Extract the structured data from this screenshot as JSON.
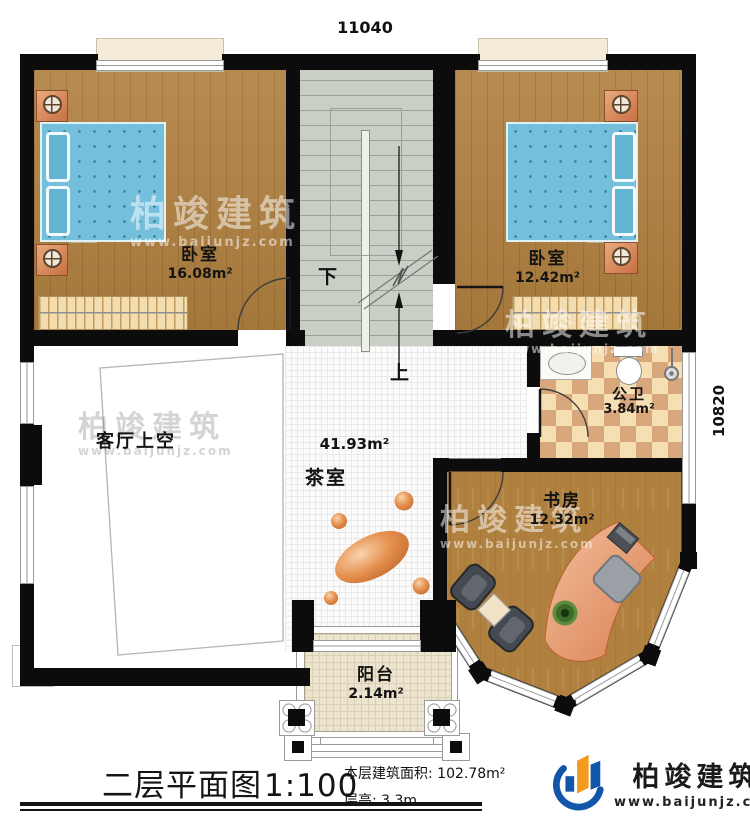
{
  "dimensions": {
    "top_width": "11040",
    "right_height": "10820"
  },
  "rooms": {
    "bedroom_left": {
      "name": "卧室",
      "area": "16.08m²"
    },
    "bedroom_right": {
      "name": "卧室",
      "area": "12.42m²"
    },
    "bathroom": {
      "name": "公卫",
      "area": "3.84m²"
    },
    "study": {
      "name": "书房",
      "area": "12.32m²"
    },
    "tea_room": {
      "name": "茶室",
      "area": "41.93m²"
    },
    "living_void": {
      "name": "客厅上空"
    },
    "balcony": {
      "name": "阳台",
      "area": "2.14m²"
    }
  },
  "stairs": {
    "down_label": "下",
    "up_label": "上"
  },
  "footer": {
    "plan_title": "二层平面图",
    "plan_scale": "1:100",
    "area_label": "本层建筑面积: ",
    "area_value": "102.78m²",
    "floor_height_label": "层高: ",
    "floor_height_value": "3.3m"
  },
  "brand": {
    "name": "柏竣建筑",
    "website": "www.baijunjz.com"
  },
  "watermark": {
    "name": "柏竣建筑",
    "website": "www.baijunjz.com"
  },
  "colors": {
    "wall": "#0c0c0c",
    "wood_floor": "#b0803f",
    "stair_floor": "#c9cfc4",
    "bed_blue": "#74bfdc",
    "tile_tan": "#d9a77c",
    "tile_cream": "#f6dfb3",
    "desk_salmon": "#e2926b",
    "brand_blue": "#1156a8",
    "brand_orange": "#f29b1d"
  }
}
